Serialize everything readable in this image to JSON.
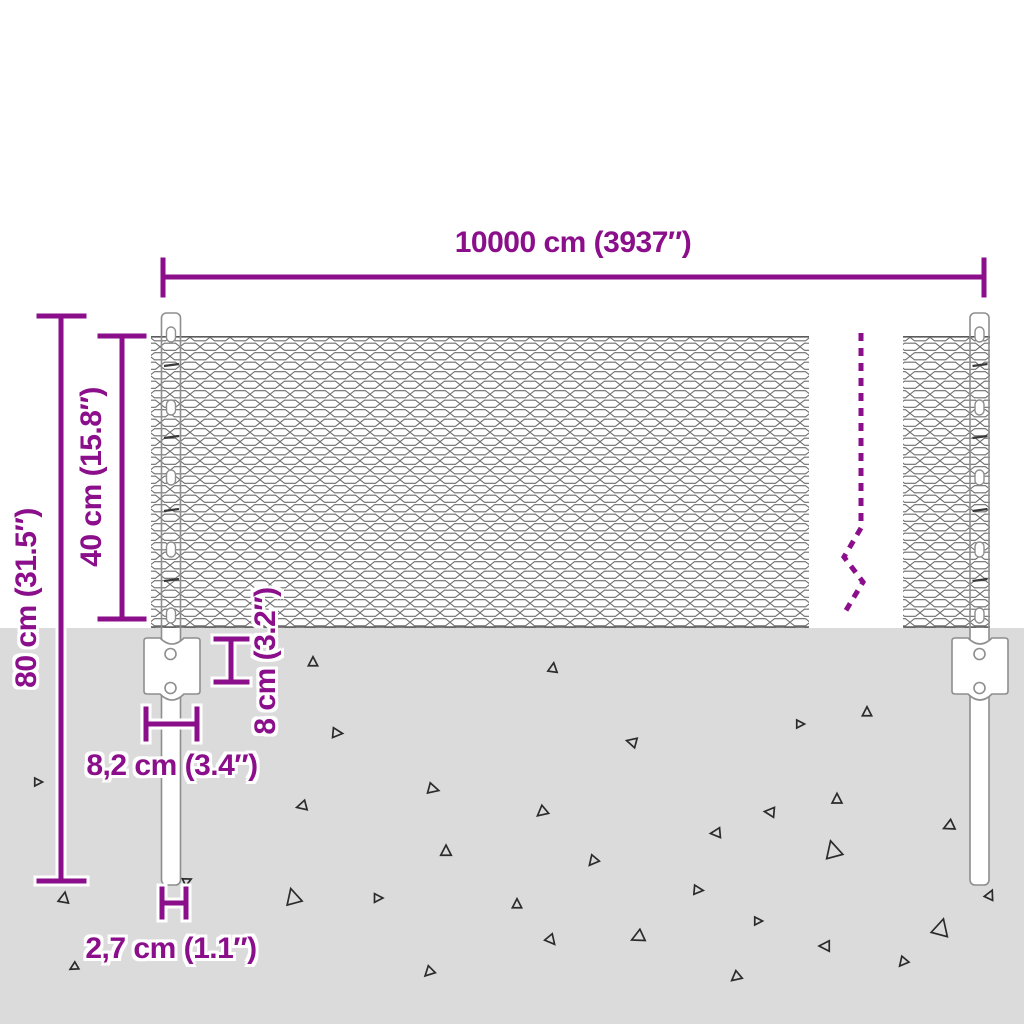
{
  "diagram": {
    "kind": "product-dimension-diagram",
    "subject": "chain-link mesh fence with two posts and ground anchors",
    "labels": {
      "total_width": "10000 cm (3937″)",
      "total_height": "80 cm (31.5″)",
      "mesh_height": "40 cm (15.8″)",
      "anchor_height": "8 cm (3.2″)",
      "anchor_width": "8,2 cm (3.4″)",
      "post_width": "2,7 cm (1.1″)"
    },
    "colors": {
      "dimension_accent": "#8B0E8B",
      "ground": "#DBDBDB",
      "mesh_wire": "#6D6D6D",
      "outline": "#8E8E8E",
      "gravel_mark": "#2B2B2B"
    }
  }
}
